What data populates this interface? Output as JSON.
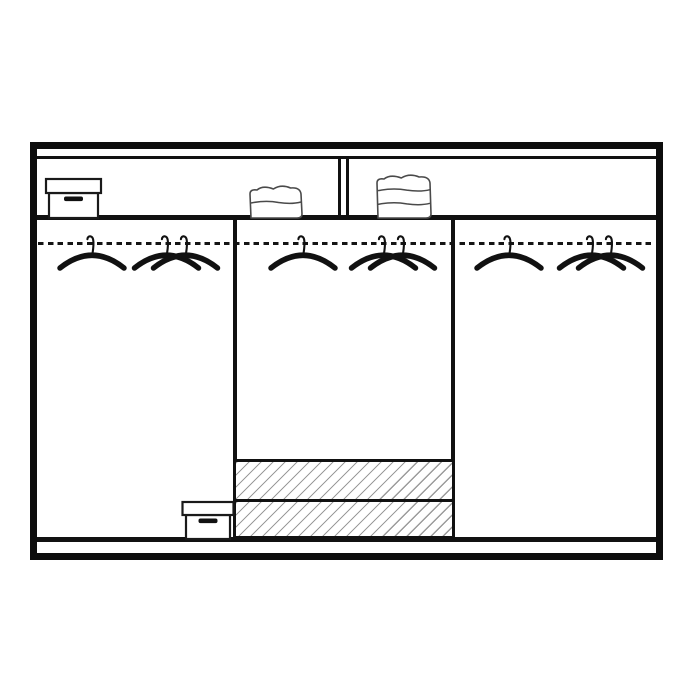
{
  "title": "wardrobe-interior-layout-diagram",
  "colors": {
    "background": "#ffffff",
    "line": "#111111",
    "hatch": "#9b9b9b",
    "towel_outline": "#4a4a4a",
    "box_outline": "#1a1a1a",
    "box_handle": "#111111"
  },
  "diagram": {
    "description": "Line drawing of a three-section wardrobe interior: full-width top shelf split into two compartments holding a storage box and two stacks of folded linen; a dashed hanging rail with single and paired clothes hangers in all three sections; two diagonally hatched drawers and a floor storage box in the lower area.",
    "top_shelf": {
      "compartments": 2,
      "contents": [
        "storage-box",
        "folded-towel-stack-2-layers",
        "folded-towel-stack-3-layers"
      ]
    },
    "sections": [
      {
        "name": "left",
        "hangers": 3,
        "floor_items": [
          "storage-box"
        ]
      },
      {
        "name": "middle",
        "hangers": 3,
        "floor_items": [
          "drawer",
          "drawer"
        ]
      },
      {
        "name": "right",
        "hangers": 3,
        "floor_items": []
      }
    ],
    "drawers": {
      "count": 2,
      "fill": "diagonal-hatch",
      "hatch_direction": "/"
    },
    "items": [
      {
        "type": "box",
        "name": "storage-box-top-shelf",
        "x": 73.5,
        "base_y": 218,
        "lid_w": 55,
        "lid_h": 14,
        "body_w": 49,
        "body_h": 25
      },
      {
        "type": "towels",
        "name": "folded-towel-stack-2",
        "x": 276,
        "base_y": 218,
        "w": 52,
        "h": 30,
        "layers": 2
      },
      {
        "type": "towels",
        "name": "folded-towel-stack-3",
        "x": 404,
        "base_y": 218,
        "w": 54,
        "h": 41,
        "layers": 3
      },
      {
        "type": "hanger",
        "name": "hanger-left-single",
        "x": 92,
        "rail_y": 243,
        "count": 1
      },
      {
        "type": "hanger",
        "name": "hanger-left-pair",
        "x": 176,
        "rail_y": 243,
        "count": 2
      },
      {
        "type": "hanger",
        "name": "hanger-middle-single",
        "x": 303,
        "rail_y": 243,
        "count": 1
      },
      {
        "type": "hanger",
        "name": "hanger-middle-pair",
        "x": 393,
        "rail_y": 243,
        "count": 2
      },
      {
        "type": "hanger",
        "name": "hanger-right-single",
        "x": 509,
        "rail_y": 243,
        "count": 1
      },
      {
        "type": "hanger",
        "name": "hanger-right-pair",
        "x": 601,
        "rail_y": 243,
        "count": 2
      },
      {
        "type": "box",
        "name": "storage-box-floor",
        "x": 208,
        "base_y": 539,
        "lid_w": 51,
        "lid_h": 13,
        "body_w": 44,
        "body_h": 24
      }
    ],
    "pair_offset": 9.5
  }
}
